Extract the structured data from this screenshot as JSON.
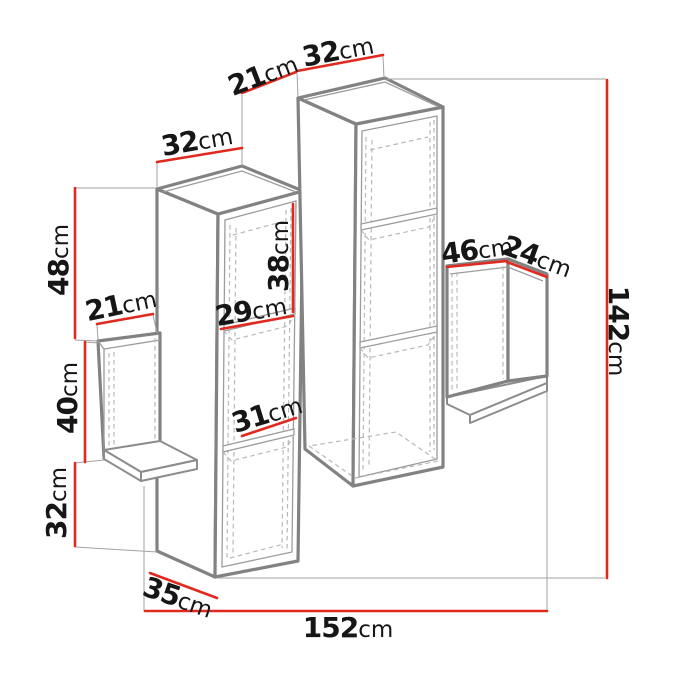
{
  "diagram": {
    "type": "furniture-dimension-diagram",
    "unit": "cm",
    "colors": {
      "dimension_line": "#e02a20",
      "outline": "#828282",
      "hidden_edge": "#b8b8b8",
      "extension_line": "#a2a2a2",
      "label_text": "#161616",
      "background": "#ffffff"
    },
    "dims": [
      {
        "id": "left-column-top-width",
        "value": "32",
        "unit": "cm"
      },
      {
        "id": "column-top-depth",
        "value": "21",
        "unit": "cm"
      },
      {
        "id": "right-column-top-width",
        "value": "32",
        "unit": "cm"
      },
      {
        "id": "left-upper-height",
        "value": "48",
        "unit": "cm"
      },
      {
        "id": "left-shelf-depth",
        "value": "21",
        "unit": "cm"
      },
      {
        "id": "left-middle-height",
        "value": "40",
        "unit": "cm"
      },
      {
        "id": "left-lower-height",
        "value": "32",
        "unit": "cm"
      },
      {
        "id": "bottom-depth",
        "value": "35",
        "unit": "cm"
      },
      {
        "id": "total-width",
        "value": "152",
        "unit": "cm"
      },
      {
        "id": "total-height",
        "value": "142",
        "unit": "cm"
      },
      {
        "id": "inner-compartment-height",
        "value": "38",
        "unit": "cm"
      },
      {
        "id": "inner-compartment-width",
        "value": "29",
        "unit": "cm"
      },
      {
        "id": "inner-lower-width",
        "value": "31",
        "unit": "cm"
      },
      {
        "id": "right-shelf-width",
        "value": "46",
        "unit": "cm"
      },
      {
        "id": "right-shelf-depth",
        "value": "24",
        "unit": "cm"
      }
    ]
  }
}
